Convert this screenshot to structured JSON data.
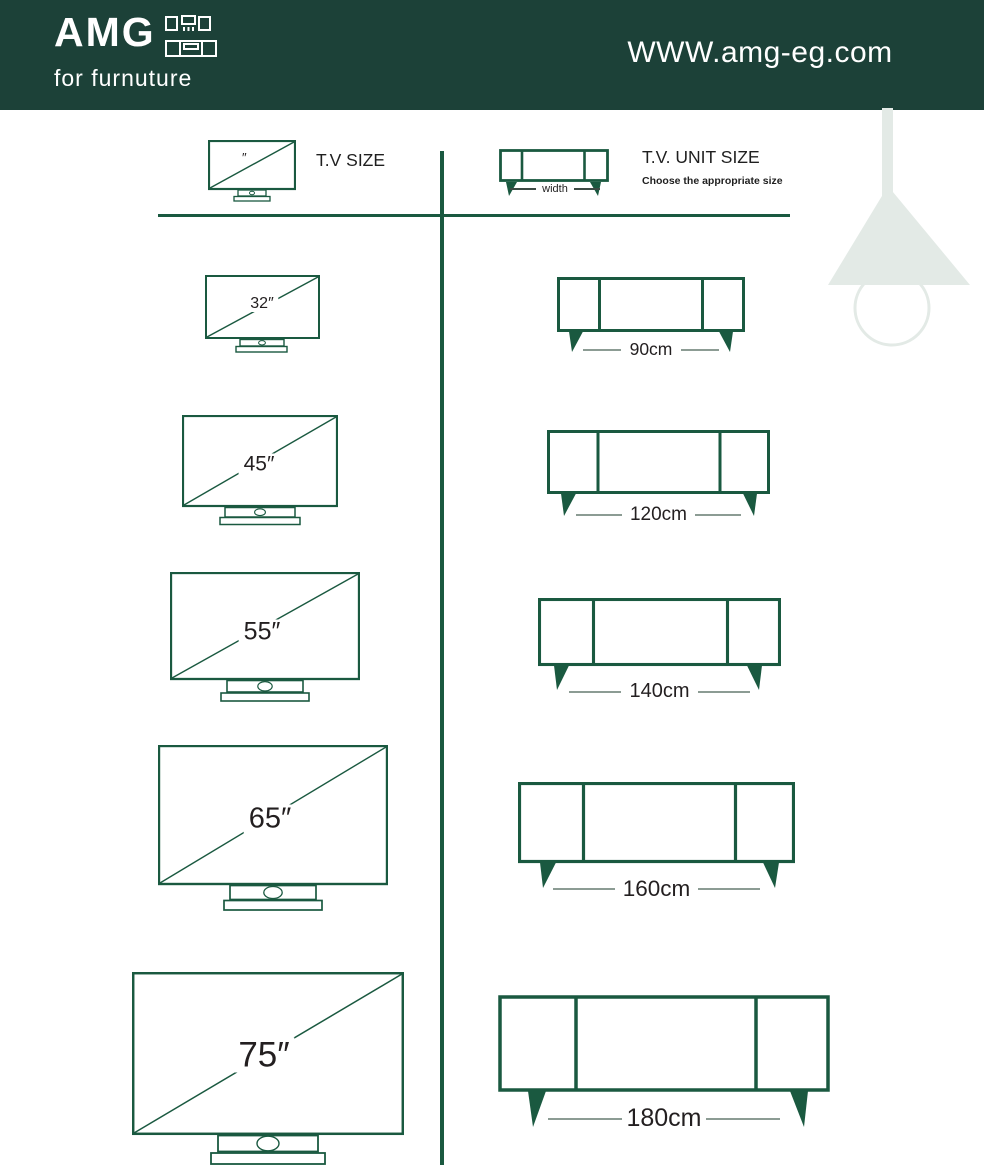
{
  "header": {
    "brand": "AMG",
    "tagline": "for furnuture",
    "website": "WWW.amg-eg.com"
  },
  "legend": {
    "tv_label": "T.V SIZE",
    "tv_mark": "″",
    "unit_label": "T.V. UNIT SIZE",
    "unit_sublabel": "Choose the appropriate size",
    "width_label": "width"
  },
  "rows": [
    {
      "tv_size": "32″",
      "unit_width": "90cm"
    },
    {
      "tv_size": "45″",
      "unit_width": "120cm"
    },
    {
      "tv_size": "55″",
      "unit_width": "140cm"
    },
    {
      "tv_size": "65″",
      "unit_width": "160cm"
    },
    {
      "tv_size": "75″",
      "unit_width": "180cm"
    }
  ],
  "colors": {
    "header_bg": "#1c4138",
    "line_green": "#1a5940",
    "label_dark": "#231f20",
    "dash_gray": "#8c9c94",
    "lamp": "#e3eae6",
    "background": "#ffffff"
  }
}
